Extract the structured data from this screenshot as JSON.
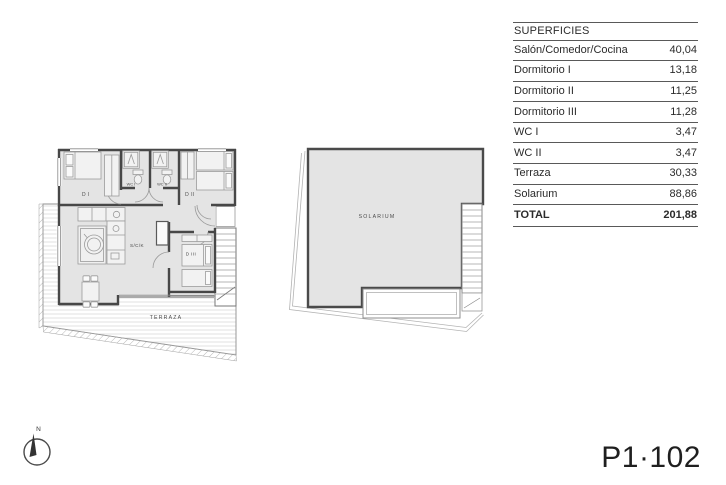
{
  "table": {
    "title": "SUPERFICIES",
    "rows": [
      {
        "label": "Salón/Comedor/Cocina",
        "value": "40,04"
      },
      {
        "label": "Dormitorio I",
        "value": "13,18"
      },
      {
        "label": "Dormitorio II",
        "value": "11,25"
      },
      {
        "label": "Dormitorio III",
        "value": "11,28"
      },
      {
        "label": "WC I",
        "value": "3,47"
      },
      {
        "label": "WC II",
        "value": "3,47"
      },
      {
        "label": "Terraza",
        "value": "30,33"
      },
      {
        "label": "Solarium",
        "value": "88,86"
      }
    ],
    "total": {
      "label": "TOTAL",
      "value": "201,88"
    }
  },
  "floor_plan": {
    "rooms": {
      "dormitorio1": "D I",
      "wc1": "WC I",
      "wc2": "WC II",
      "dormitorio2": "D II",
      "salon_comedor_cocina": "S/C/K",
      "dormitorio3": "D III",
      "terraza": "TERRAZA"
    }
  },
  "solarium_plan": {
    "label": "SOLARIUM"
  },
  "compass": {
    "north_label": "N"
  },
  "unit_code": "P1·102",
  "colors": {
    "room_fill": "#e4e4e4",
    "wall": "#474747",
    "furniture_line": "#9b9b9b",
    "table_line": "#595959",
    "text": "#2b2b2b"
  }
}
